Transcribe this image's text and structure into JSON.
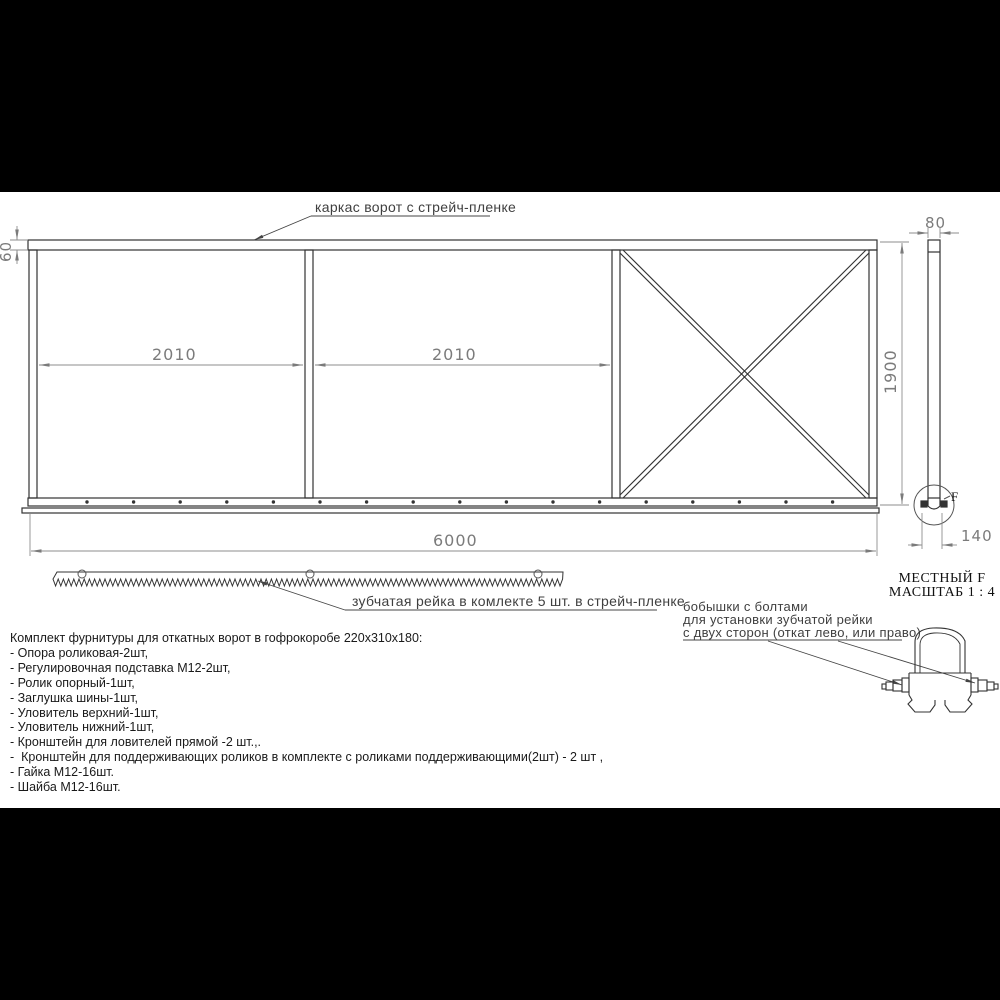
{
  "drawing": {
    "frame_label": "каркас ворот с стрейч-пленке",
    "rack_label": "зубчатая рейка в комлекте 5 шт. в стрейч-пленке",
    "boss_label_line1": "бобышки с болтами",
    "boss_label_line2": "для установки зубчатой рейки",
    "boss_label_line3": "с двух сторон (откат лево, или право)",
    "detail_view": {
      "title": "МЕСТНЫЙ F",
      "scale": "МАСШТАБ 1 : 4",
      "ref_letter": "F"
    },
    "dimensions": {
      "top_rail_height": "60",
      "panel_width_1": "2010",
      "panel_width_2": "2010",
      "total_width": "6000",
      "frame_height": "1900",
      "profile_width": "80",
      "rail_width": "140"
    }
  },
  "parts_list": {
    "title": "Комплект фурнитуры для откатных ворот в гофрокоробе 220х310х180:",
    "items": [
      "- Опора роликовая-2шт,",
      "- Регулировочная подставка М12-2шт,",
      "- Ролик опорный-1шт,",
      "- Заглушка шины-1шт,",
      "- Уловитель верхний-1шт,",
      "- Уловитель нижний-1шт,",
      "- Кронштейн для ловителей прямой -2 шт.,.",
      "-  Кронштейн для поддерживающих роликов в комплекте с роликами поддерживающими(2шт) - 2 шт ,",
      "- Гайка М12-16шт.",
      "- Шайба М12-16шт."
    ]
  },
  "colors": {
    "line": "#333333",
    "dimension": "#7b7b7b",
    "label": "#3f3f3f",
    "background": "#ffffff",
    "letterbox": "#000000"
  }
}
